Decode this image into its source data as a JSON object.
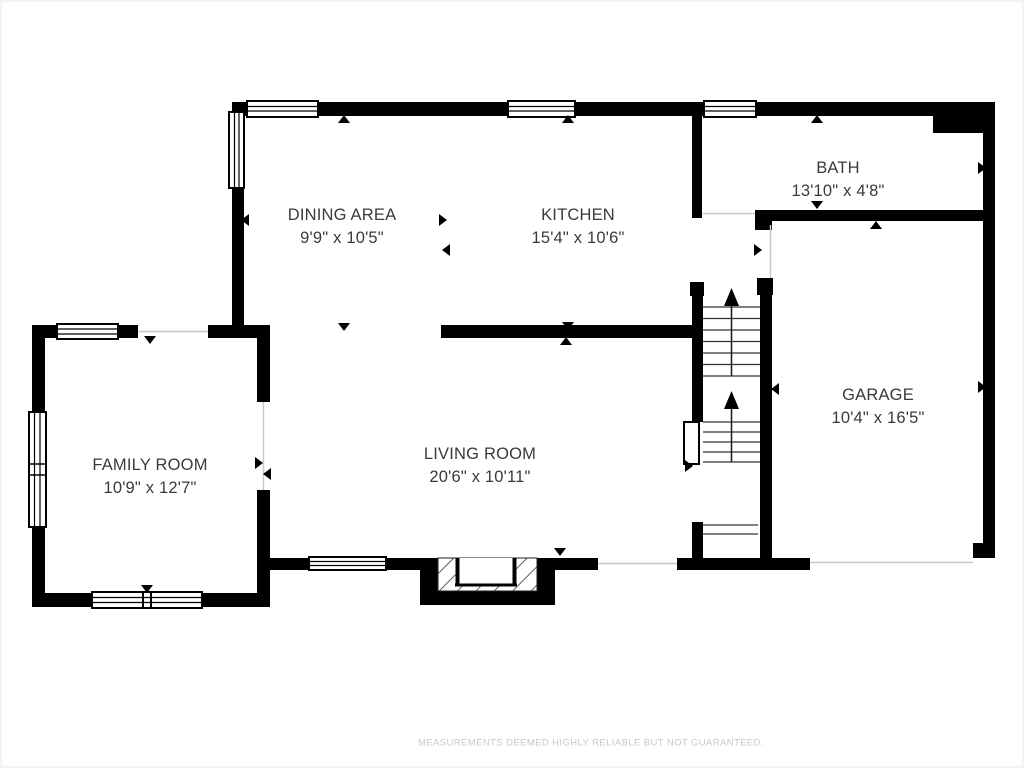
{
  "rooms": {
    "dining_area": {
      "name": "DINING AREA",
      "dims": "9'9\" x 10'5\""
    },
    "kitchen": {
      "name": "KITCHEN",
      "dims": "15'4\" x 10'6\""
    },
    "bath": {
      "name": "BATH",
      "dims": "13'10\" x 4'8\""
    },
    "family_room": {
      "name": "FAMILY ROOM",
      "dims": "10'9\" x 12'7\""
    },
    "living_room": {
      "name": "LIVING ROOM",
      "dims": "20'6\" x 10'11\""
    },
    "garage": {
      "name": "GARAGE",
      "dims": "10'4\" x 16'5\""
    }
  },
  "footer": {
    "disclaimer": "MEASUREMENTS DEEMED HIGHLY RELIABLE BUT NOT GUARANTEED."
  },
  "colors": {
    "wall": "#000000",
    "label_text": "#3a3a3a",
    "disclaimer_text": "#c8c8c8",
    "opening_line": "#c8c8c8",
    "background": "#ffffff"
  }
}
